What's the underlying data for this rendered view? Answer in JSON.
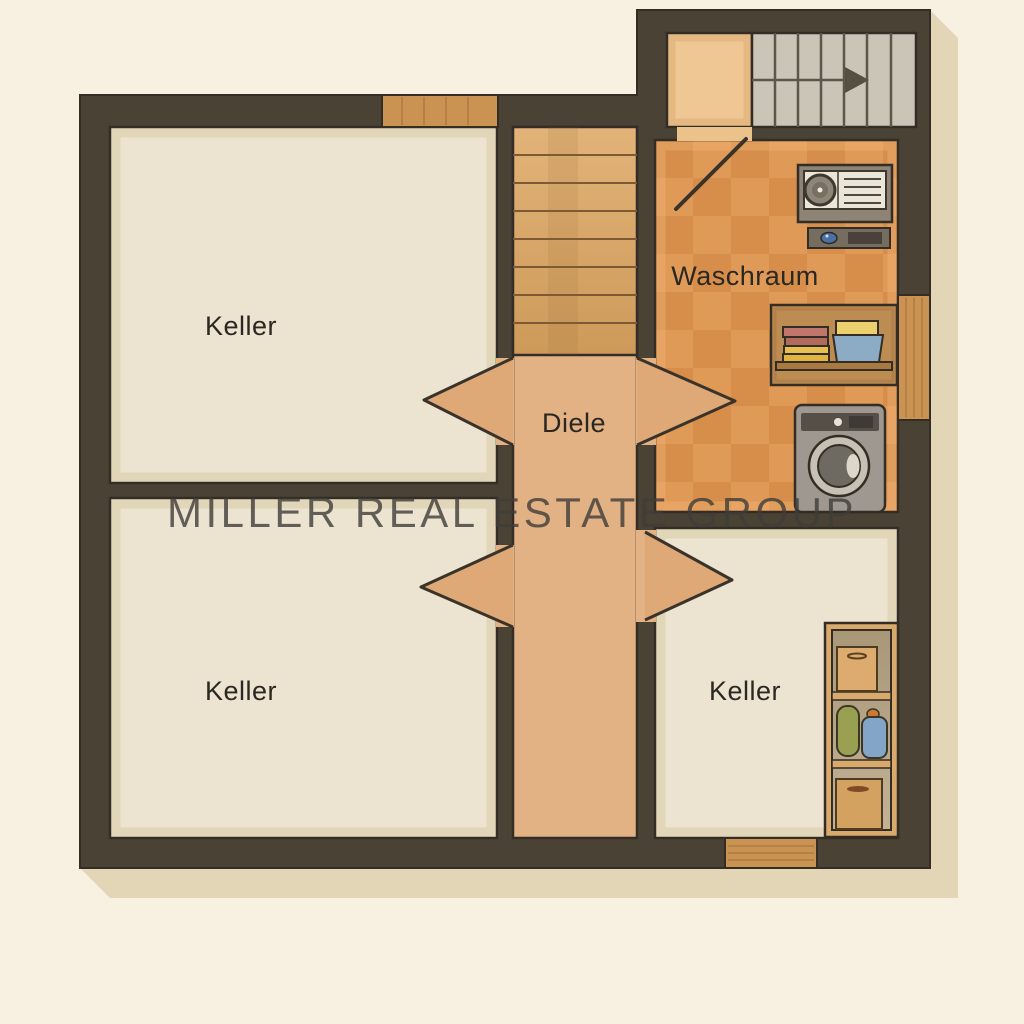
{
  "plan": {
    "type": "basement floor plan",
    "watermark": {
      "text": "MILLER REAL ESTATE GROUP"
    },
    "rooms": {
      "keller_top_left": {
        "label": "Keller"
      },
      "keller_bottom_left": {
        "label": "Keller"
      },
      "keller_bottom_right": {
        "label": "Keller"
      },
      "diele": {
        "label": "Diele"
      },
      "waschraum": {
        "label": "Waschraum"
      }
    },
    "fixtures": {
      "stairwell": [
        "stairs-up-icon",
        "direction-arrow-icon"
      ],
      "diele": [
        "wooden-stairs-icon",
        "passage-arrow-icon",
        "passage-arrow-icon"
      ],
      "waschraum": [
        "door-swing-icon",
        "control-panel-icon",
        "intercom-icon",
        "laundry-shelf-icon",
        "washing-machine-icon"
      ],
      "keller_bottom_right": [
        "storage-shelf-icon"
      ],
      "windows": [
        "window-top-icon",
        "window-right-icon",
        "window-bottom-icon"
      ]
    },
    "palette": {
      "background": "#f8f1e1",
      "shadow": "#e2d6b7",
      "wall": "#4a4335",
      "room_floor": "#ece3d0",
      "hallway_floor": "#e2b184",
      "laundry_floor": "#e09a58",
      "laundry_checker": "#d28945",
      "landing_floor": "#eec795",
      "stair_gray": "#cbc5b8",
      "window_wood": "#cb9352",
      "stairs_wood": "#d9a467",
      "arrow_fill": "#dfa977",
      "label_color": "#2b2722",
      "watermark_color": "#3f3d39"
    }
  }
}
